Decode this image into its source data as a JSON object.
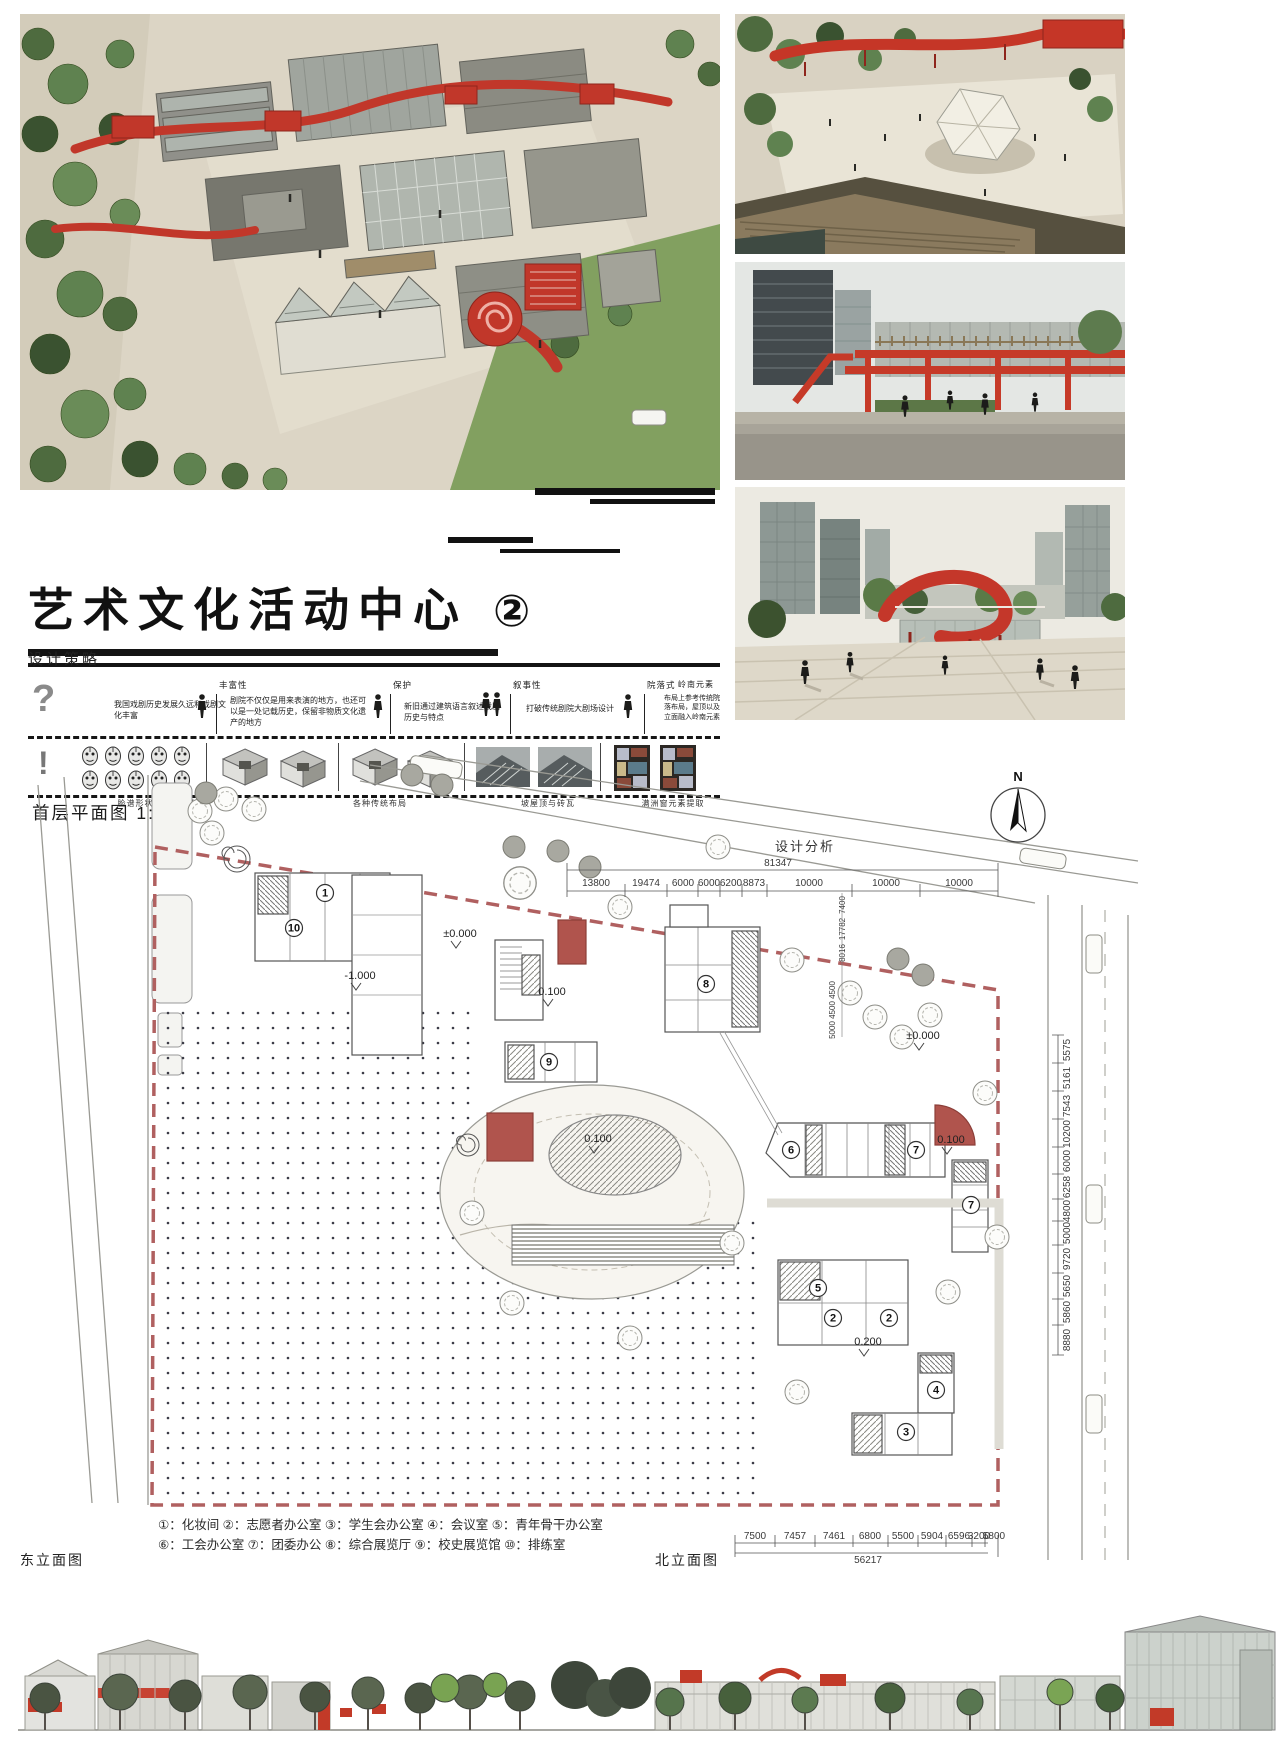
{
  "title": {
    "text": "艺术文化活动中心",
    "badge": "②"
  },
  "strategy": {
    "heading": "设计策略",
    "intro": "我国戏剧历史发展久远和戏剧文化丰富",
    "steps": [
      {
        "label": "丰富性",
        "text": "剧院不仅仅是用来表演的地方，也还可以是一处记载历史，保留非物质文化遗产的地方"
      },
      {
        "label": "保护",
        "text": "新旧通过建筑语言叙述戏剧历史与特点"
      },
      {
        "label": "叙事性",
        "text": "打破传统剧院大剧场设计"
      },
      {
        "label": "院落式",
        "text": "布局上参考传统院落布局，屋顶以及立面融入岭南元素"
      },
      {
        "label": "岭南元素",
        "text": ""
      }
    ],
    "captions": [
      "脸谱形状的元素提取",
      "各种传统布局",
      "坡屋顶与砖瓦",
      "满洲窗元素提取"
    ]
  },
  "plan": {
    "heading": "首层平面图 1:500",
    "analysis_label": "设计分析",
    "north_label": "N",
    "top_dims": {
      "total": "81347",
      "segments": [
        "13800",
        "19474",
        "6000",
        "6000",
        "6200",
        "8873",
        "10000",
        "10000",
        "10000"
      ]
    },
    "bottom_dims": {
      "total": "56217",
      "segments": [
        "7500",
        "7457",
        "7461",
        "6800",
        "5500",
        "5904",
        "6596",
        "3200",
        "5800"
      ]
    },
    "right_dims": [
      "5575",
      "5161",
      "7543",
      "10200",
      "6000",
      "6258",
      "4800",
      "5000",
      "9720",
      "5650",
      "5860",
      "8880"
    ],
    "inner_dims": [
      "7400",
      "17782",
      "8016",
      "4500",
      "4500",
      "5000"
    ],
    "levels": {
      "l1": "±0.000",
      "l2": "-1.000",
      "l3": "0.100",
      "l4": "0.100",
      "l5": "±0.000",
      "l6": "0.100",
      "l7": "0.200"
    },
    "rooms": {
      "n1": "1",
      "n2": "2",
      "n3": "3",
      "n4": "4",
      "n5": "5",
      "n6": "6",
      "n7": "7",
      "n8": "8",
      "n9": "9",
      "n10": "10"
    },
    "legend_line1": "①：化妆间 ②：志愿者办公室 ③：学生会办公室 ④：会议室 ⑤：青年骨干办公室",
    "legend_line2": "⑥：工会办公室 ⑦：团委办公 ⑧：综合展览厅 ⑨：校史展览馆 ⑩：排练室"
  },
  "elevations": {
    "east_label": "东立面图",
    "north_label": "北立面图"
  },
  "colors": {
    "accent_red": "#c1372a",
    "plan_red": "#b0544d",
    "boundary_red": "#b06060",
    "tree_green": "#4e6b3f"
  }
}
